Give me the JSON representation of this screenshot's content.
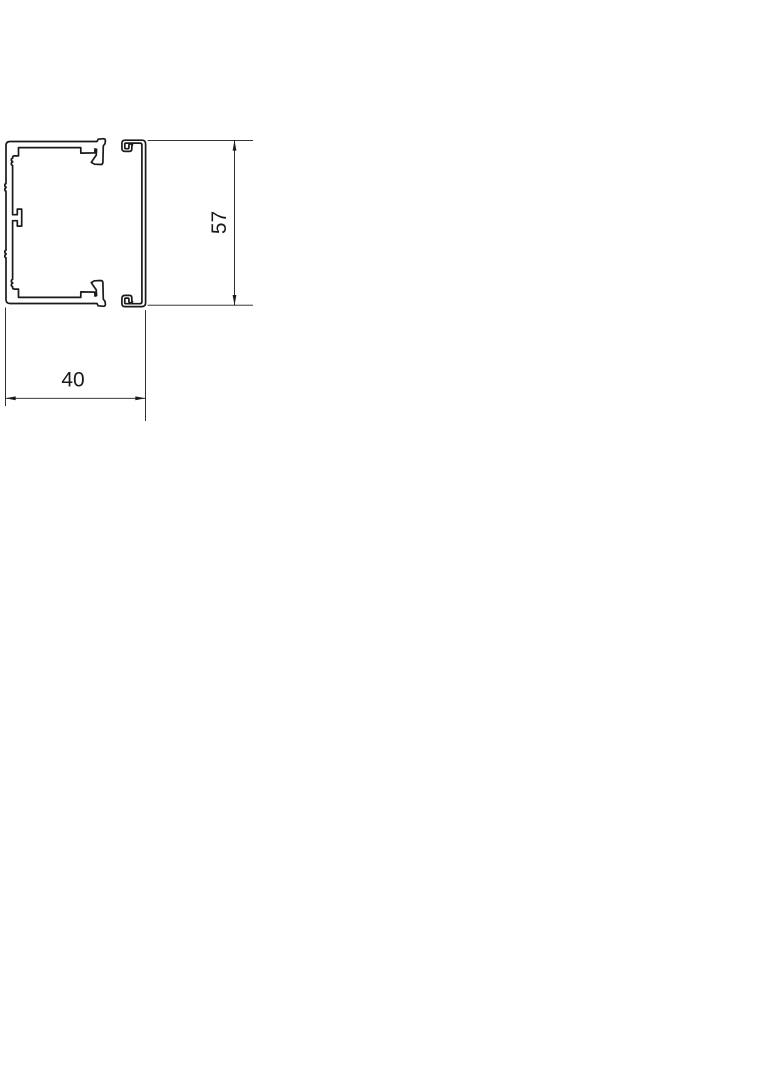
{
  "drawing": {
    "kind": "technical cross-section of cable trunking (base profile and cover profile)",
    "line_color": "#1a1a1a",
    "background_color": "#ffffff",
    "width_dimension": {
      "label": "40",
      "value": 40,
      "orientation": "horizontal"
    },
    "height_dimension": {
      "label": "57",
      "value": 57,
      "orientation": "vertical"
    },
    "parts": [
      {
        "name": "trunking-base-profile"
      },
      {
        "name": "trunking-cover-profile"
      }
    ]
  }
}
